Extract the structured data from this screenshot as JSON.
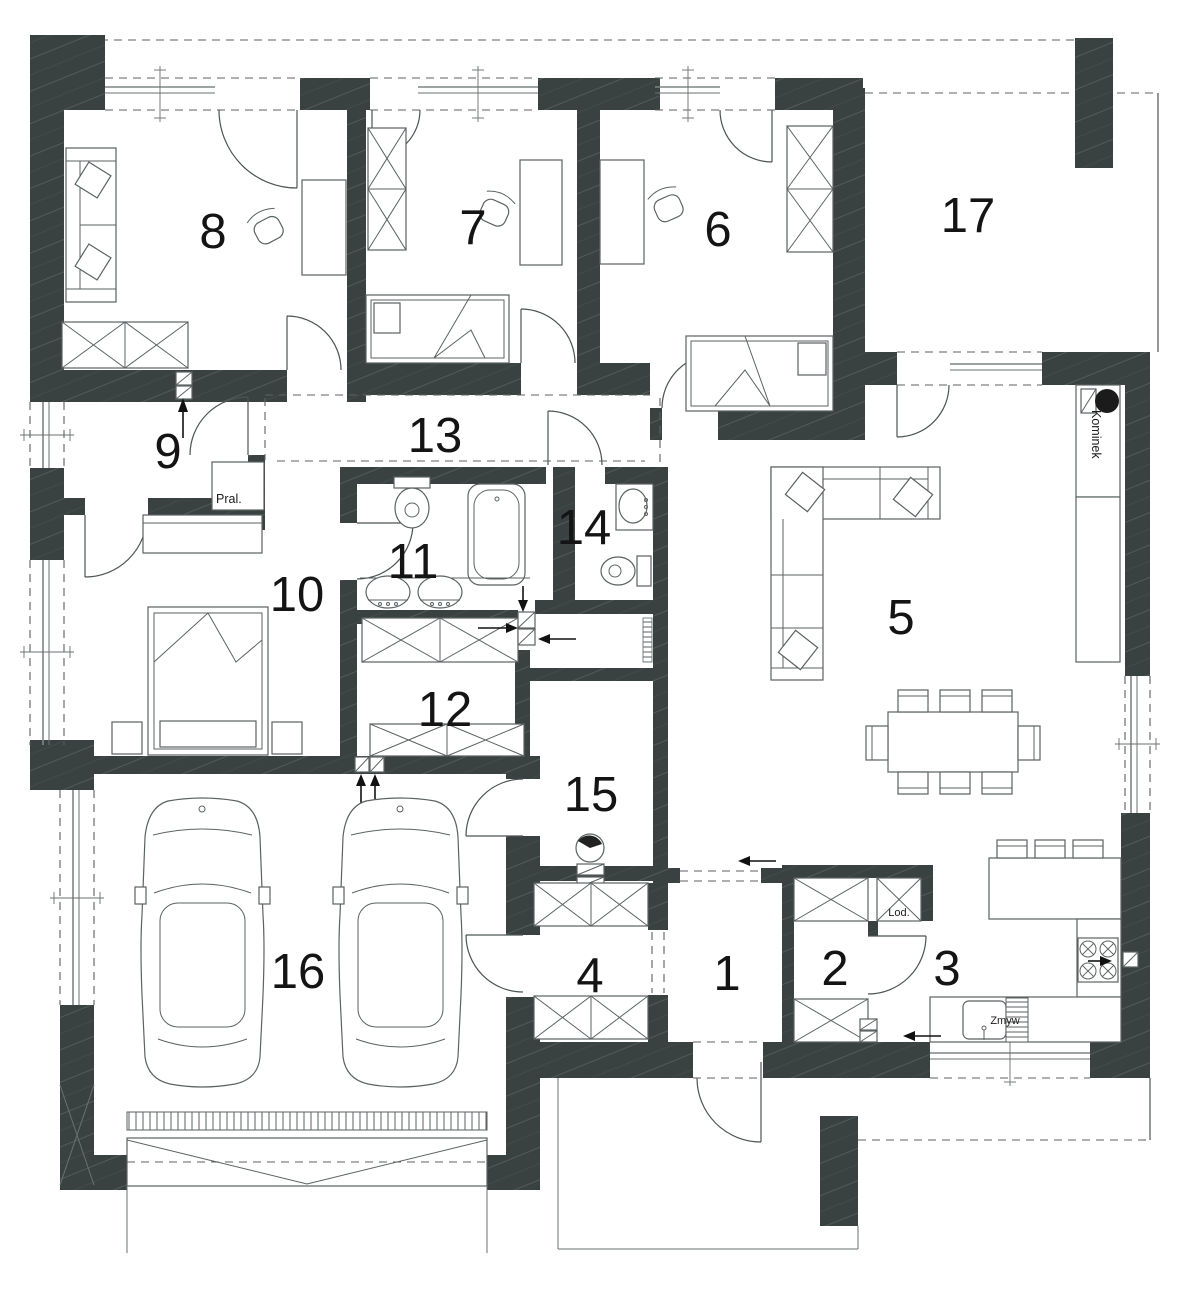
{
  "plan": {
    "type": "house-floor-plan",
    "colors": {
      "wall": "#3a4141",
      "line": "#4c5353",
      "text": "#141414"
    },
    "rooms": [
      {
        "n": "1"
      },
      {
        "n": "2"
      },
      {
        "n": "3"
      },
      {
        "n": "4"
      },
      {
        "n": "5"
      },
      {
        "n": "6"
      },
      {
        "n": "7"
      },
      {
        "n": "8"
      },
      {
        "n": "9"
      },
      {
        "n": "10"
      },
      {
        "n": "11"
      },
      {
        "n": "12"
      },
      {
        "n": "13"
      },
      {
        "n": "14"
      },
      {
        "n": "15"
      },
      {
        "n": "16"
      },
      {
        "n": "17"
      }
    ],
    "labels": {
      "washing_machine": "Pral.",
      "fireplace": "Kominek",
      "fridge": "Lod.",
      "dishwasher": "Zmyw"
    }
  }
}
